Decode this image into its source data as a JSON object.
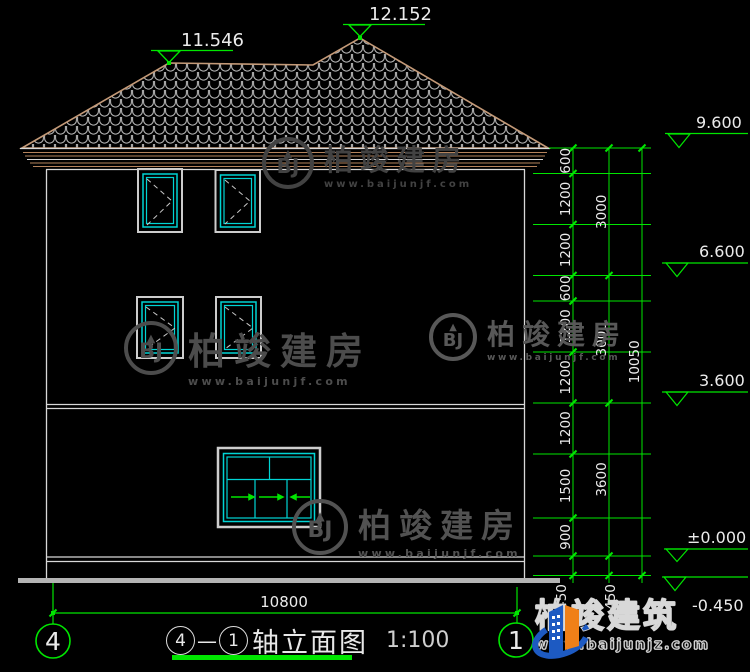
{
  "title_bar": {
    "axis_left": "4",
    "axis_right": "1",
    "separator": "—",
    "label": "轴立面图",
    "scale": "1:100"
  },
  "axis_bubbles": {
    "left": "4",
    "right": "1"
  },
  "levels": {
    "ridge": "11.546",
    "peak": "12.152",
    "right": [
      "9.600",
      "6.600",
      "3.600",
      "±0.000",
      "-0.450"
    ]
  },
  "dims": {
    "inner": [
      "600",
      "1200",
      "1200",
      "600",
      "1200",
      "1200",
      "1200",
      "1500",
      "900",
      "450"
    ],
    "mid": [
      "3000",
      "3000",
      "3600",
      "450"
    ],
    "total": "10050",
    "width": "10800"
  },
  "watermarks": {
    "monogram": "BJ",
    "roof": "▲",
    "brand": "柏竣建房",
    "url": "www.baijunjf.com"
  },
  "footer_logo": {
    "brand": "柏竣建筑",
    "url": "www.baijunjz.com"
  },
  "colors": {
    "dim_green": "#00e600",
    "window_cyan": "#00d4d4",
    "roof_tan": "#c49a78",
    "frame_gray": "#cdcdcd"
  }
}
